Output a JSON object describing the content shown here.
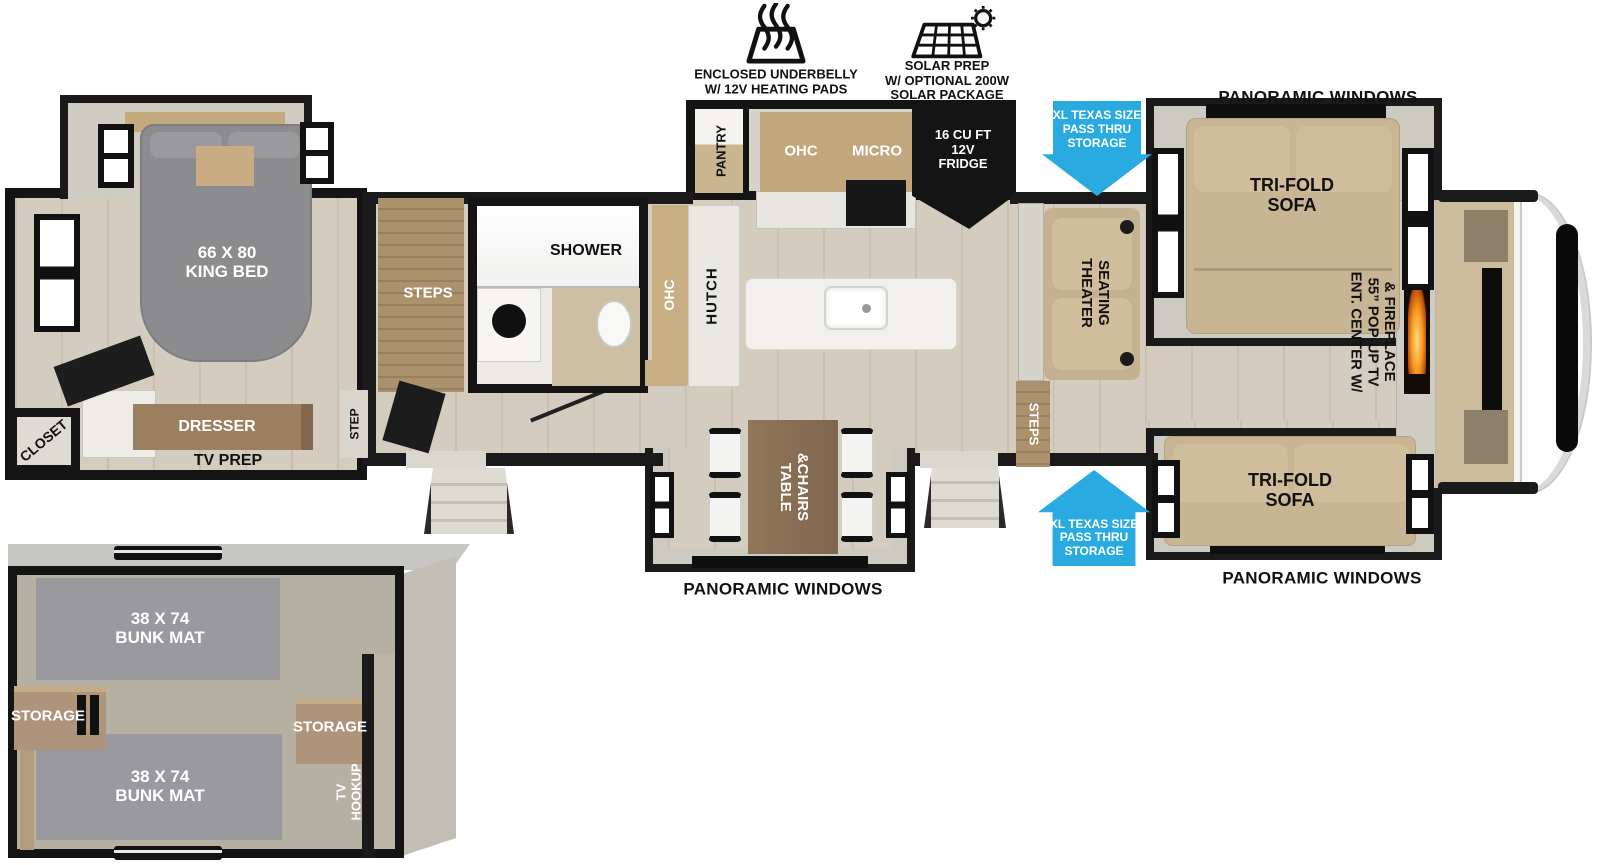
{
  "features": {
    "underbelly": {
      "icon": "heating-pads-icon",
      "label": "ENCLOSED UNDERBELLY\nW/ 12V HEATING PADS"
    },
    "solar": {
      "icon": "solar-panel-icon",
      "label": "SOLAR PREP\nW/ OPTIONAL 200W\nSOLAR PACKAGE"
    }
  },
  "callouts": {
    "panoramic_top": "PANORAMIC WINDOWS",
    "panoramic_bottom_right": "PANORAMIC WINDOWS",
    "panoramic_bottom_center": "PANORAMIC WINDOWS",
    "pass_thru_top": "XL TEXAS SIZE\nPASS THRU\nSTORAGE",
    "pass_thru_bottom": "XL TEXAS SIZE\nPASS THRU\nSTORAGE"
  },
  "bedroom": {
    "king_bed": "66 X 80\nKING BED",
    "closet": "CLOSET",
    "dresser": "DRESSER",
    "tv_prep": "TV PREP",
    "step": "STEP"
  },
  "bathroom": {
    "shower": "SHOWER",
    "steps": "STEPS"
  },
  "kitchen": {
    "pantry": "PANTRY",
    "ohc_upper": "OHC",
    "micro": "MICRO",
    "fridge": "16 CU FT\n12V\nFRIDGE",
    "ohc_side": "OHC",
    "hutch": "HUTCH"
  },
  "dinette": {
    "table_chairs": "TABLE\n&CHAIRS"
  },
  "living": {
    "theater_seating": "THEATER\nSEATING",
    "steps": "STEPS",
    "sofa_top": "TRI-FOLD\nSOFA",
    "sofa_bottom": "TRI-FOLD\nSOFA",
    "ent_center": "ENT. CENTER W/\n55” POP-UP TV\n& FIREPLACE"
  },
  "bunk_room": {
    "bunk_mat_top": "38 X 74\nBUNK MAT",
    "bunk_mat_bottom": "38 X 74\nBUNK MAT",
    "storage_left": "STORAGE",
    "storage_right": "STORAGE",
    "tv_hookup": "TV\nHOOKUP"
  },
  "colors": {
    "arrow_blue": "#29abe2",
    "wall_black": "#1a1a1a",
    "sofa_tan": "#c7b593",
    "bed_gray": "#8c8c8e",
    "wood_brown": "#9c7f5e",
    "flame_orange": "#f7941d"
  }
}
